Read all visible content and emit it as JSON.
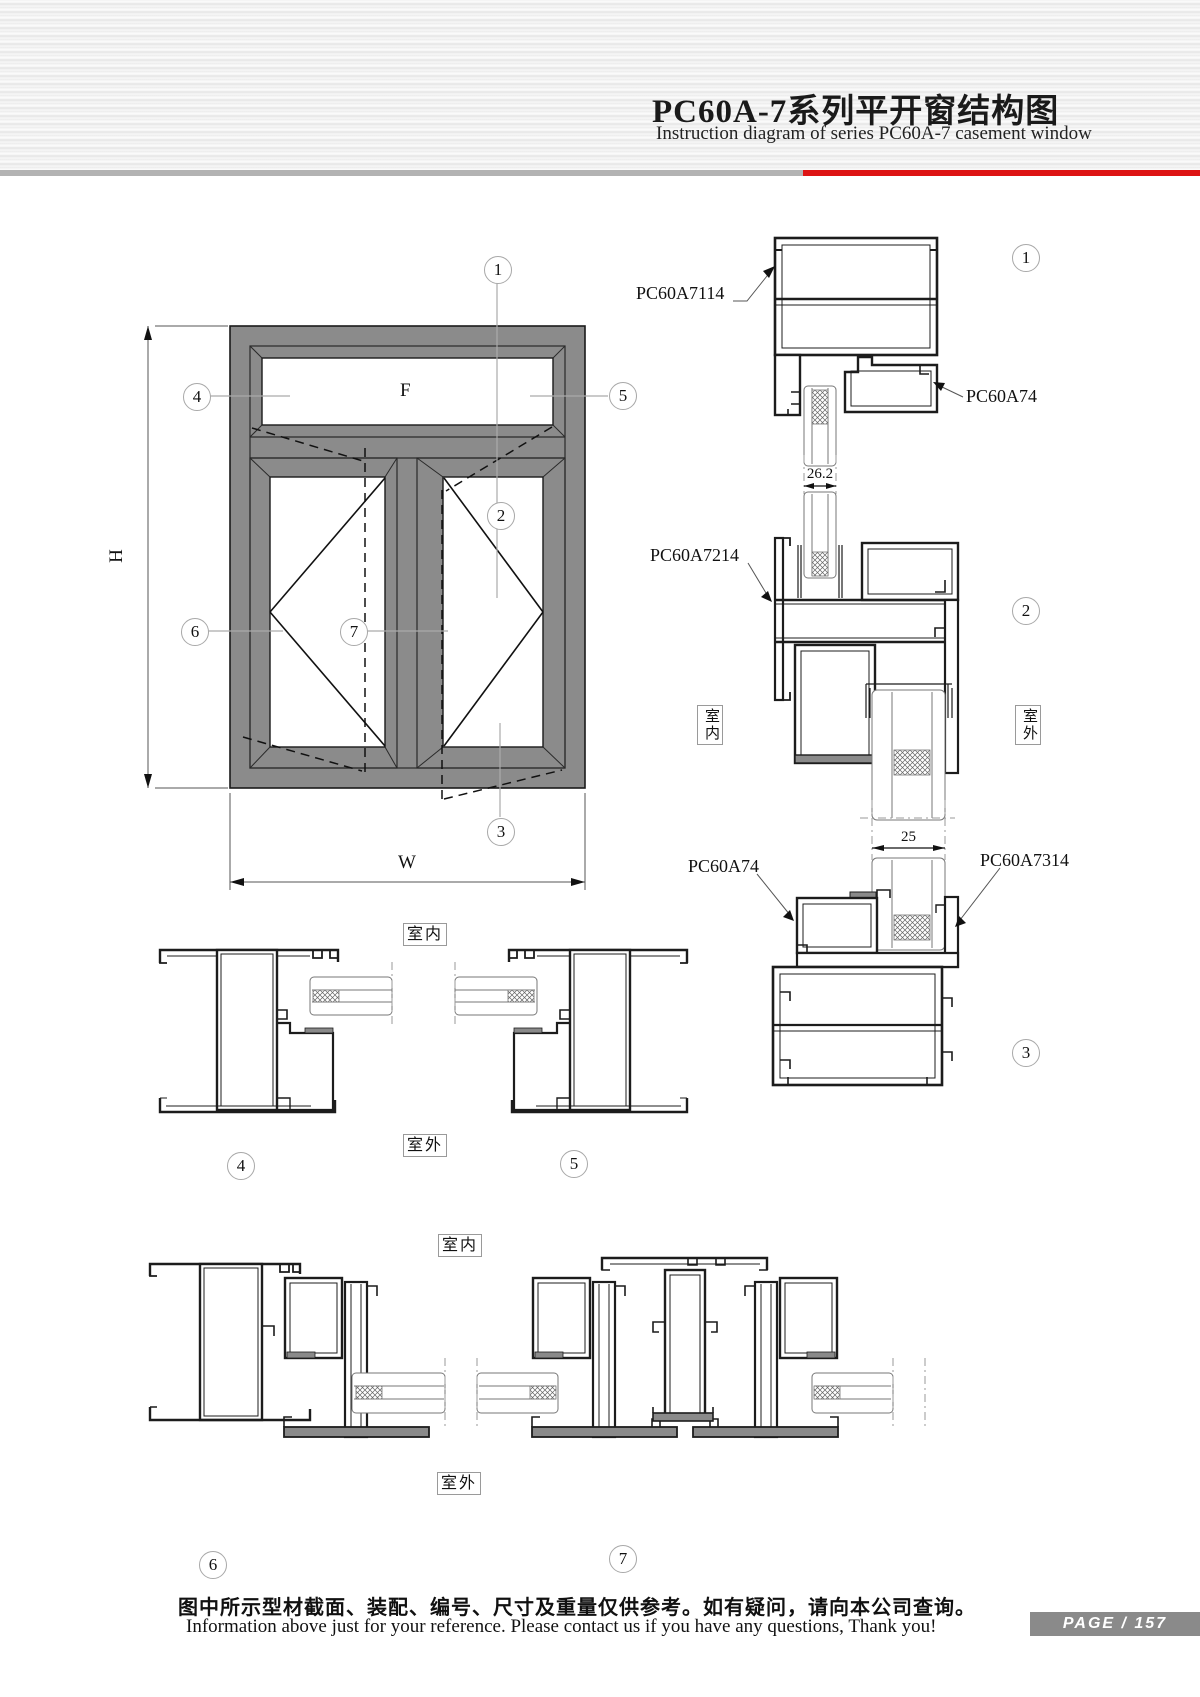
{
  "header": {
    "title_cn": "PC60A-7系列平开窗结构图",
    "title_en": "Instruction diagram of series PC60A-7 casement window"
  },
  "elevation": {
    "height_label": "H",
    "width_label": "W",
    "fixed_panel_label": "F"
  },
  "callouts": {
    "c1": "1",
    "c2": "2",
    "c3": "3",
    "c4": "4",
    "c5": "5",
    "c6": "6",
    "c7": "7"
  },
  "profiles": {
    "head_frame": "PC60A7114",
    "sash_top": "PC60A74",
    "transom": "PC60A7214",
    "sash_bottom": "PC60A74",
    "sill_frame": "PC60A7314"
  },
  "dimensions": {
    "fixed_glass_thickness": "26.2",
    "sash_glass_thickness": "25"
  },
  "locations": {
    "indoor": "室内",
    "outdoor": "室外"
  },
  "footer": {
    "note_cn": "图中所示型材截面、装配、编号、尺寸及重量仅供参考。如有疑问，请向本公司查询。",
    "note_en": "Information above just for your reference. Please contact us if you have any questions, Thank you!",
    "page_label": "PAGE / 157"
  }
}
